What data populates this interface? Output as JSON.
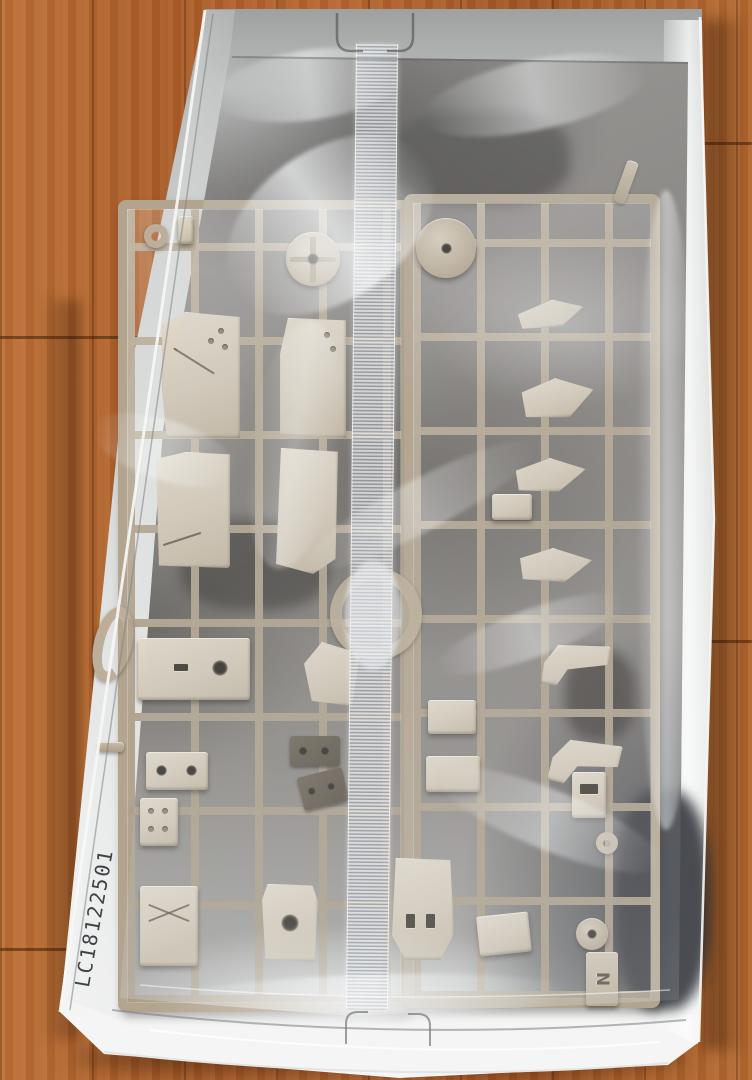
{
  "scene": {
    "type": "photograph",
    "description": "Opened white model-kit box on a wooden floor; tan plastic sprues with parts sealed in a clear plastic bag",
    "lot_code": "LC18122501",
    "sprue_letter": "N"
  },
  "colors": {
    "wood_floor": "#a95d2a",
    "wood_seam": "#58280a",
    "box_white": "#f4f5f4",
    "box_wall_grey": "#a6a8a7",
    "sprue_tan": "#b2a48e",
    "part_beige": "#d8cfc0",
    "bag_highlight": "#f0f2f4",
    "interior_shadow": "#4e4a47",
    "code_text": "#23232a"
  }
}
